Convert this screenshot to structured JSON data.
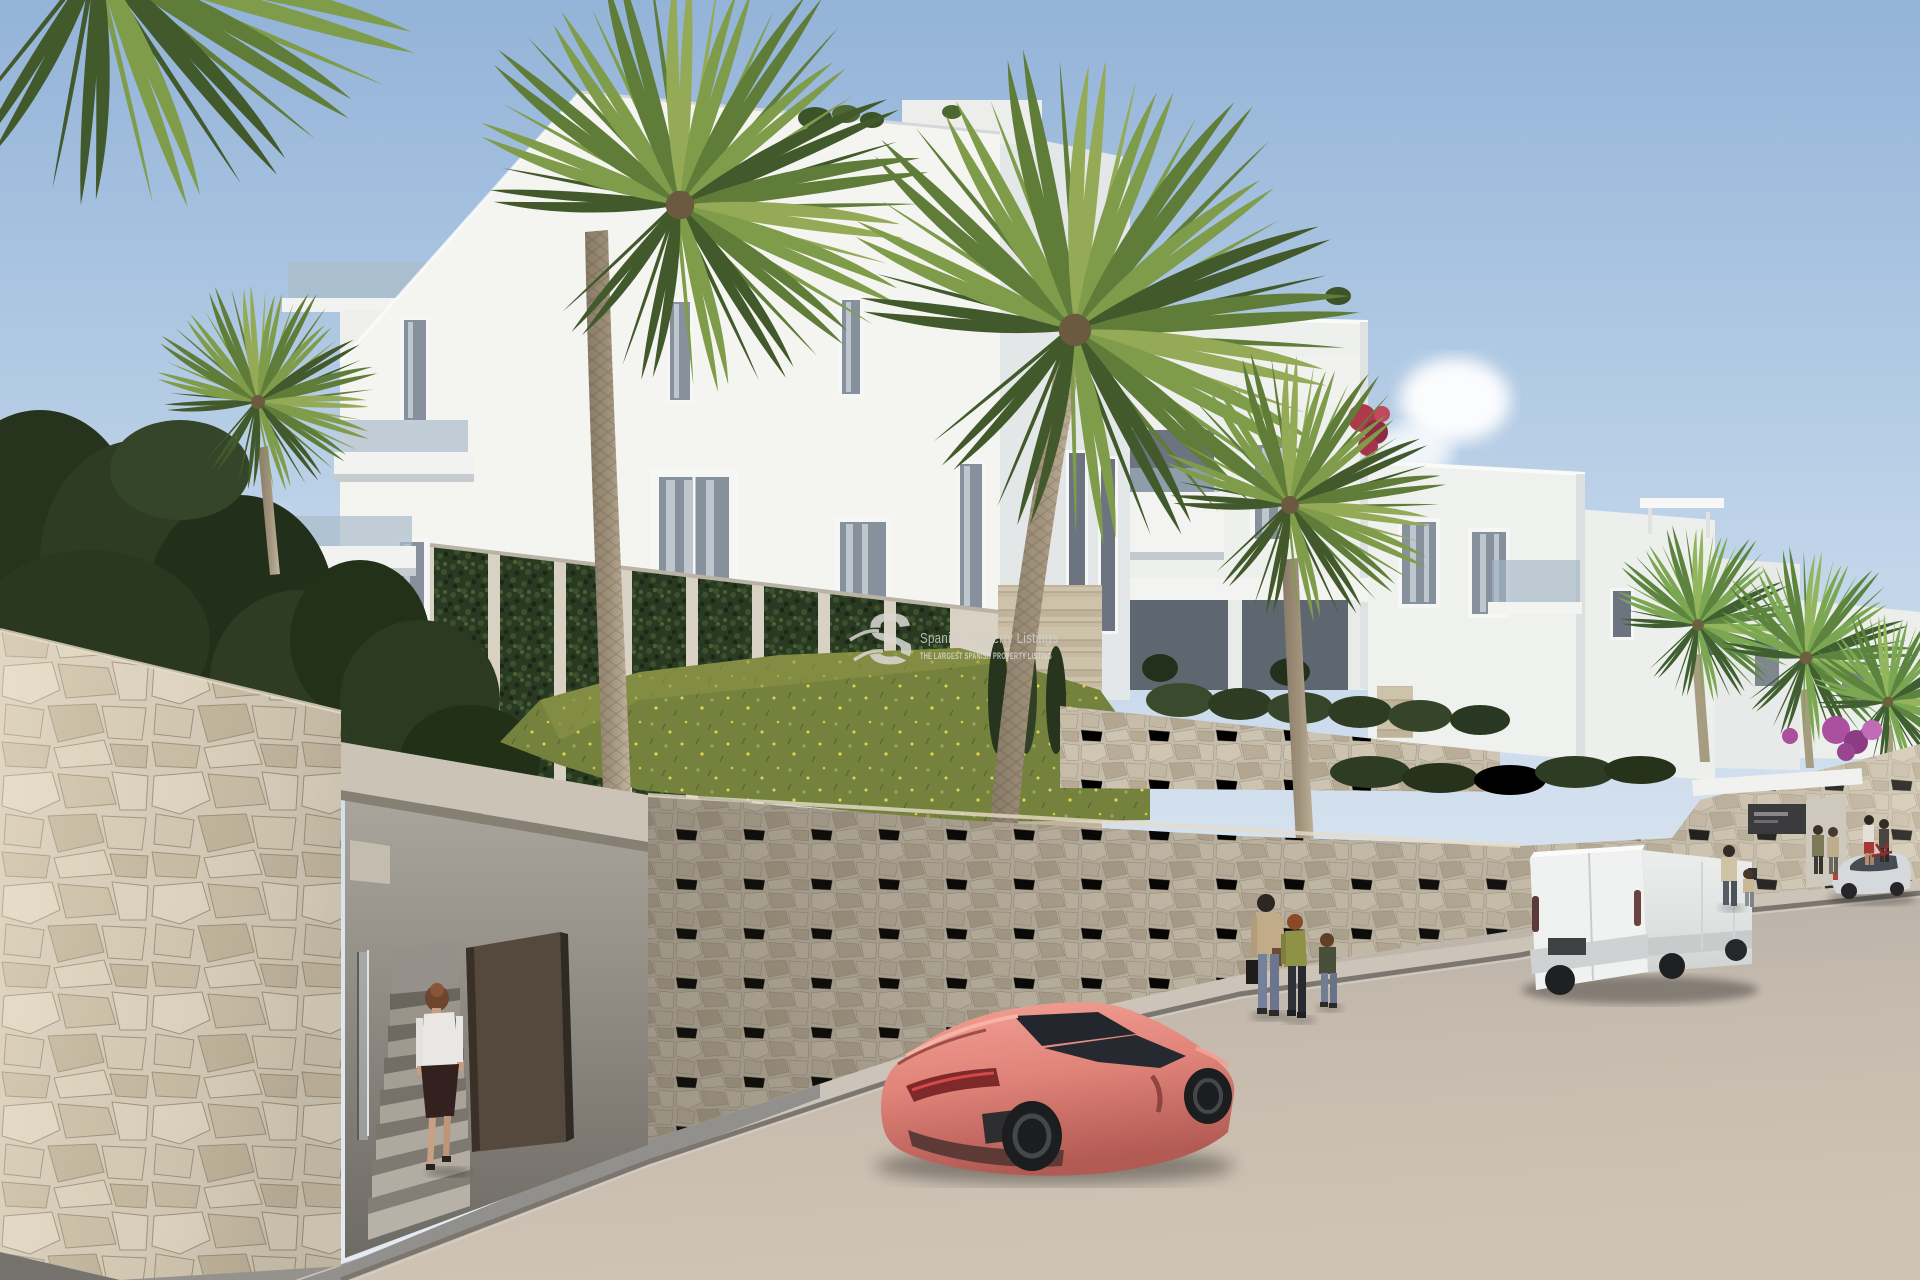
{
  "watermark": {
    "logo_letter": "S",
    "title": "Spanish Property Listings",
    "tagline": "THE LARGEST SPANISH PROPERTY LISTING"
  },
  "palette": {
    "sky_top": "#93b3d8",
    "sky_horizon": "#dde6f0",
    "building_white": "#f4f4f1",
    "building_shade": "#e4e7e7",
    "stone_wall": "#d2c8b5",
    "stone_joint": "#9a8e77",
    "road_lit": "#c6bbae",
    "road_shadow": "#8f8c88",
    "sidewalk": "#ccc4b8",
    "grass": "#75823d",
    "hedge": "#2e3c24",
    "ivy": "#2a3a22",
    "palm_green": "#5f7c39",
    "palm_trunk": "#a2937c",
    "car_coral": "#e08379",
    "van_white": "#f0f2f1",
    "sedan_silver": "#d6d9db",
    "door_brown": "#55483c",
    "parasol_cream": "#ece4cd",
    "bougainvillea": "#9b4ea0",
    "flower_red": "#b0384a",
    "flower_yellow": "#e6d64e"
  },
  "scene": {
    "type": "architectural-exterior-render",
    "objects": [
      "sky",
      "clouds",
      "apartment-building-left-block",
      "apartment-building-mid-section",
      "apartment-building-right-section",
      "far-right-buildings",
      "roof-parasol",
      "rooftop-terrace",
      "ivy-green-wall",
      "travertine-pillar",
      "grass-slope",
      "cypress-trees",
      "hedge-left",
      "palm-trees",
      "street-retaining-wall",
      "pedestrian-entrance",
      "entrance-stairs",
      "entrance-door",
      "woman-entering-stairs",
      "complex-gate",
      "complex-entrance-sign",
      "sidewalk",
      "road",
      "pink-sports-coupe",
      "white-panel-van",
      "silver-sedan",
      "pedestrians-wall-group",
      "man-with-child",
      "couple-at-gate",
      "people-near-gate",
      "watermark"
    ]
  }
}
